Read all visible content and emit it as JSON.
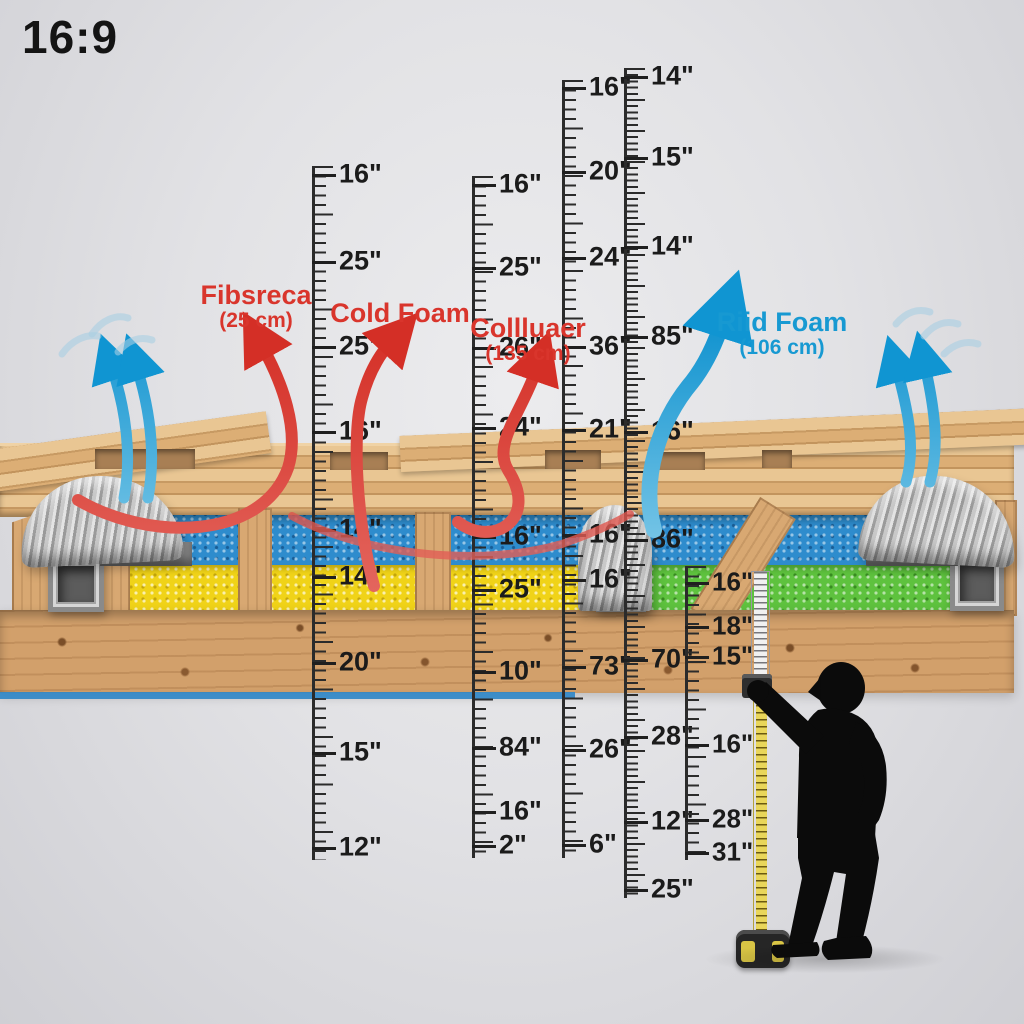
{
  "badge": {
    "text": "16:9"
  },
  "annotations": [
    {
      "name": "label-fibsreca",
      "line1": "Fibsreca",
      "line2": "(25 cm)",
      "color": "#d9352c",
      "x": 256,
      "y": 281
    },
    {
      "name": "label-cold-foam",
      "line1": "Cold Foam",
      "line2": "",
      "color": "#d9352c",
      "x": 400,
      "y": 299
    },
    {
      "name": "label-colluaer",
      "line1": "Collluaer",
      "line2": "(135 cm)",
      "color": "#d9352c",
      "x": 528,
      "y": 314
    },
    {
      "name": "label-riid-foam",
      "line1": "Riid Foam",
      "line2": "(106 cm)",
      "color": "#1799d2",
      "x": 782,
      "y": 308
    }
  ],
  "rulers": [
    {
      "name": "ruler-1",
      "x": 312,
      "top": 166,
      "height": 694,
      "spacing": 9.5,
      "font": 27,
      "labels": [
        [
          "16\"",
          175
        ],
        [
          "25\"",
          262
        ],
        [
          "25\"",
          347
        ],
        [
          "16\"",
          432
        ],
        [
          "14\"",
          530
        ],
        [
          "14\"",
          577
        ],
        [
          "20\"",
          663
        ],
        [
          "15\"",
          753
        ],
        [
          "12\"",
          848
        ]
      ]
    },
    {
      "name": "ruler-2",
      "x": 472,
      "top": 176,
      "height": 682,
      "spacing": 9.5,
      "font": 27,
      "labels": [
        [
          "16\"",
          185
        ],
        [
          "25\"",
          268
        ],
        [
          "26\"",
          348
        ],
        [
          "24\"",
          428
        ],
        [
          "16\"",
          537
        ],
        [
          "25\"",
          590
        ],
        [
          "10\"",
          672
        ],
        [
          "84\"",
          748
        ],
        [
          "16\"",
          812
        ],
        [
          "2\"",
          846
        ]
      ]
    },
    {
      "name": "ruler-3",
      "x": 562,
      "top": 80,
      "height": 778,
      "spacing": 9.5,
      "font": 27,
      "labels": [
        [
          "16\"",
          88
        ],
        [
          "20\"",
          172
        ],
        [
          "24\"",
          258
        ],
        [
          "36\"",
          347
        ],
        [
          "21\"",
          430
        ],
        [
          "16\"",
          535
        ],
        [
          "16\"",
          580
        ],
        [
          "73\"",
          667
        ],
        [
          "26\"",
          750
        ],
        [
          "6\"",
          845
        ]
      ]
    },
    {
      "name": "ruler-4",
      "x": 624,
      "top": 68,
      "height": 830,
      "spacing": 6.2,
      "font": 27,
      "labels": [
        [
          "14\"",
          77
        ],
        [
          "15\"",
          158
        ],
        [
          "14\"",
          247
        ],
        [
          "85\"",
          337
        ],
        [
          "16\"",
          432
        ],
        [
          "86\"",
          540
        ],
        [
          "70\"",
          660
        ],
        [
          "28\"",
          737
        ],
        [
          "12\"",
          822
        ],
        [
          "25\"",
          890
        ]
      ]
    },
    {
      "name": "ruler-5",
      "x": 685,
      "top": 566,
      "height": 294,
      "spacing": 9.5,
      "font": 26,
      "labels": [
        [
          "16\"",
          583
        ],
        [
          "18\"",
          627
        ],
        [
          "15\"",
          657
        ],
        [
          "16\"",
          745
        ],
        [
          "28\"",
          820
        ],
        [
          "31\"",
          853
        ]
      ]
    }
  ],
  "arrows": [
    {
      "name": "heat-arrow-fibsreca",
      "color": "red",
      "width": 12,
      "head": true,
      "d": "M 78 500 C 150 542, 262 540, 288 468 C 300 430, 282 382, 262 346"
    },
    {
      "name": "heat-arrow-cold-foam",
      "color": "red",
      "width": 12,
      "head": true,
      "d": "M 374 586 C 356 520, 352 432, 362 398 C 369 372, 380 354, 391 342"
    },
    {
      "name": "heat-arrow-colluaer",
      "color": "red",
      "width": 12,
      "head": true,
      "d": "M 458 522 C 492 548, 540 520, 508 470 C 492 444, 522 412, 537 368"
    },
    {
      "name": "heat-strand",
      "color": "red",
      "width": 8,
      "head": false,
      "opacity": 0.8,
      "d": "M 292 516 C 370 558, 486 566, 562 544 C 602 530, 620 520, 630 514"
    },
    {
      "name": "air-arrow-left-1",
      "color": "blue",
      "width": 11,
      "head": true,
      "d": "M 124 498 C 132 456, 126 410, 112 368"
    },
    {
      "name": "air-arrow-left-2",
      "color": "blue",
      "width": 11,
      "head": true,
      "d": "M 148 498 C 156 454, 150 410, 137 368"
    },
    {
      "name": "air-arrow-riid",
      "color": "blue",
      "width": 16,
      "head": true,
      "d": "M 654 530 C 640 478, 660 420, 692 382 C 706 364, 716 342, 723 320"
    },
    {
      "name": "air-arrow-right-1",
      "color": "blue",
      "width": 11,
      "head": true,
      "d": "M 906 482 C 916 448, 908 410, 897 370"
    },
    {
      "name": "air-arrow-right-2",
      "color": "blue",
      "width": 11,
      "head": true,
      "d": "M 930 482 C 940 446, 934 406, 925 366"
    }
  ],
  "swishes": [
    {
      "d": "M 62 354 C 72 340, 86 334, 98 336"
    },
    {
      "d": "M 92 334 C 102 320, 116 314, 128 318"
    },
    {
      "d": "M 118 352 C 128 340, 140 336, 152 340"
    },
    {
      "d": "M 896 324 C 906 312, 918 308, 930 312"
    },
    {
      "d": "M 924 336 C 934 324, 946 320, 958 324"
    },
    {
      "d": "M 944 354 C 954 344, 966 340, 978 344"
    }
  ],
  "colors": {
    "heat_arrow": "#d9352c",
    "air_arrow": "#17a0d6",
    "swish": "#a9cfe3",
    "foam_blue": "#2e8ccd",
    "foam_yellow": "#f0d318",
    "foam_green": "#5ec23e",
    "wood": "#ddb27b",
    "ruler_ink": "#2b2b2b"
  },
  "figure": {
    "name": "worker-silhouette",
    "tool": "tape-measure"
  }
}
